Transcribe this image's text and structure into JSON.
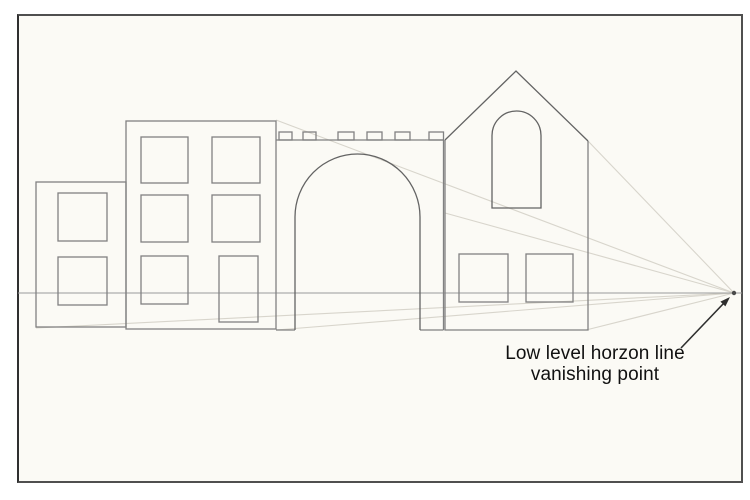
{
  "annotation": {
    "line1": "Low level horzon line",
    "line2": "vanishing point"
  },
  "colors": {
    "paper": "#FBFAF5",
    "frame_border": "#4F4F4F",
    "building_outline": "#818181",
    "detail_outline": "#636363",
    "horizon_line": "#9A9A9A",
    "construction_line": "#D8D5CC",
    "vanishing_point": "#4A4A4A",
    "arrow": "#2E2E2E",
    "label_text": "#111111"
  }
}
